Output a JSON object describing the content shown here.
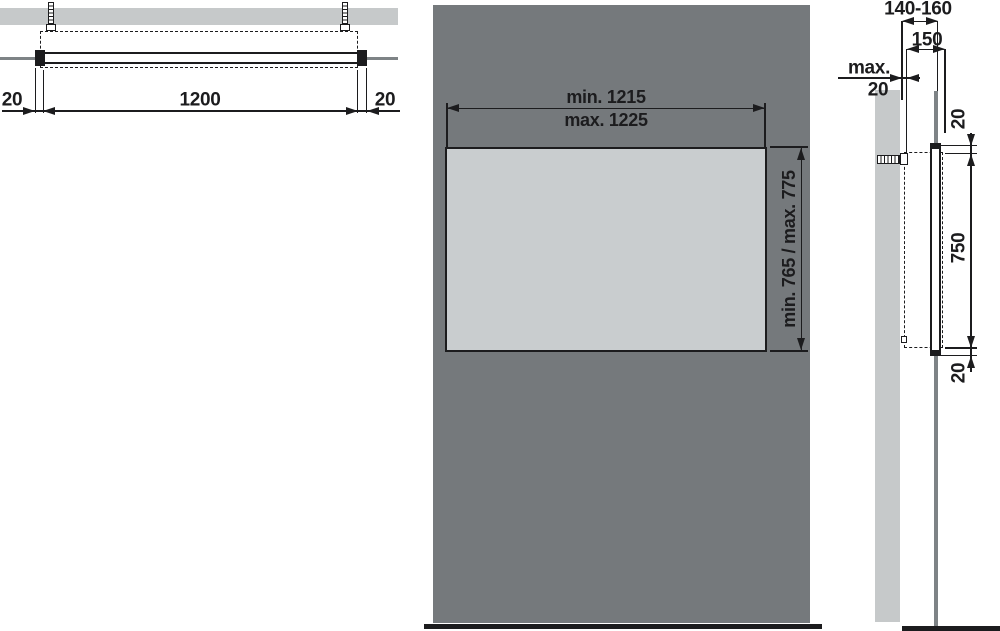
{
  "drawing": {
    "top_view": {
      "dim_left": "20",
      "dim_width": "1200",
      "dim_right": "20"
    },
    "front_view": {
      "dim_width_min": "min. 1215",
      "dim_width_max": "max. 1225",
      "dim_height": "min. 765 / max. 775"
    },
    "side_view": {
      "dim_depth_range": "140-160",
      "dim_depth": "150",
      "dim_wall_gap_word": "max.",
      "dim_wall_gap_value": "20",
      "dim_top_overhang": "20",
      "dim_height": "750",
      "dim_bottom_overhang": "20"
    },
    "colors": {
      "wall_light": "#c6c9ca",
      "panel_dark": "#75797c",
      "mirror_fill": "#c9cdcf",
      "line_black": "#1c1c1e",
      "line_gray": "#7e8386"
    }
  }
}
